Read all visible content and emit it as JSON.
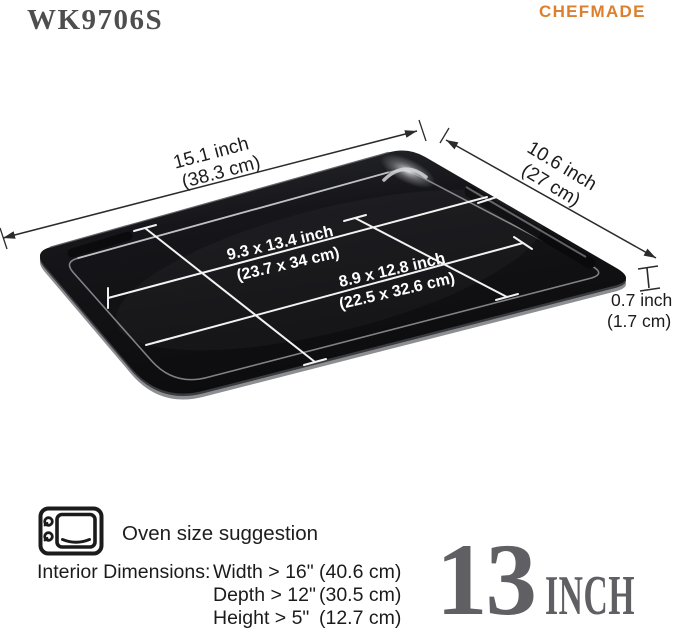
{
  "header": {
    "model": "WK9706S",
    "brand": "CHEFMADE"
  },
  "colors": {
    "brand_orange": "#DC7F2E",
    "badge_gray": "#606064",
    "tray_black": "#121214"
  },
  "diagram": {
    "length": {
      "line1": "15.1 inch",
      "line2": "(38.3 cm)"
    },
    "width": {
      "line1": "10.6 inch",
      "line2": "(27 cm)"
    },
    "interior_top": {
      "line1": "9.3 x 13.4 inch",
      "line2": "(23.7 x 34 cm)"
    },
    "interior_bottom": {
      "line1": "8.9 x 12.8 inch",
      "line2": "(22.5 x 32.6 cm)"
    },
    "height": {
      "line1": "0.7 inch",
      "line2": "(1.7 cm)"
    }
  },
  "oven": {
    "title": "Oven size suggestion",
    "prefix": "Interior Dimensions:",
    "rows": [
      {
        "dim": "Width > 16\"",
        "cm": "(40.6 cm)"
      },
      {
        "dim": "Depth > 12\"",
        "cm": "(30.5 cm)"
      },
      {
        "dim": "Height > 5\"",
        "cm": "(12.7 cm)"
      }
    ]
  },
  "badge": {
    "number": "13",
    "unit": "INCH"
  }
}
